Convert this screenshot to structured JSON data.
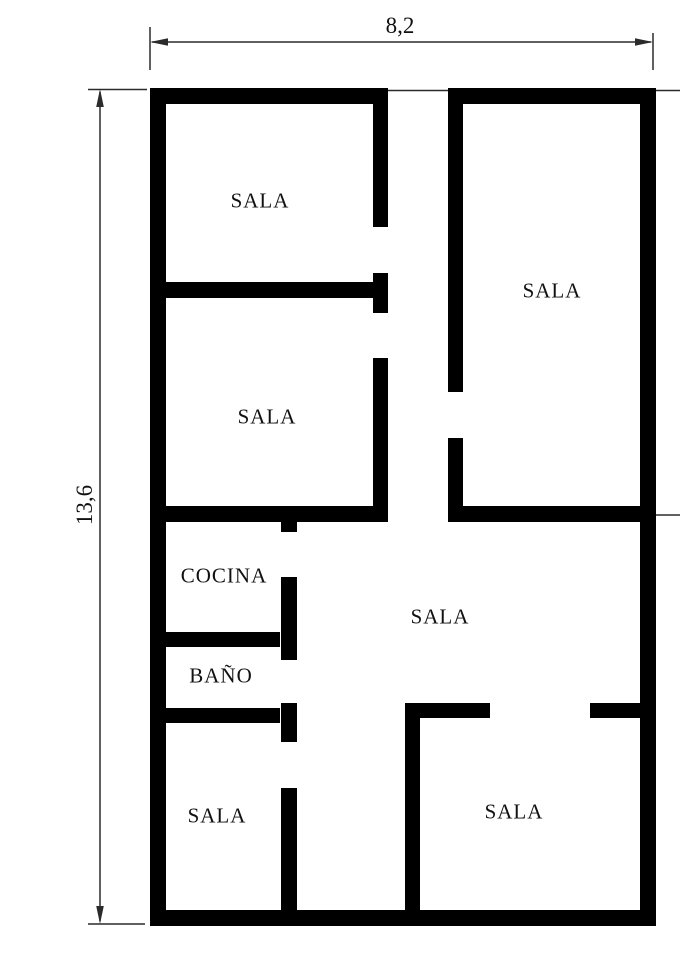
{
  "colors": {
    "wall": "#000000",
    "dimension_line": "#2b2b2b",
    "text": "#111111",
    "background": "#ffffff"
  },
  "dimensions": {
    "width_label": "8,2",
    "height_label": "13,6"
  },
  "rooms": {
    "sala_top_left": "SALA",
    "sala_top_right": "SALA",
    "sala_mid_left": "SALA",
    "cocina": "COCINA",
    "bano": "BAÑO",
    "sala_center": "SALA",
    "sala_bottom_left": "SALA",
    "sala_bottom_right": "SALA"
  }
}
